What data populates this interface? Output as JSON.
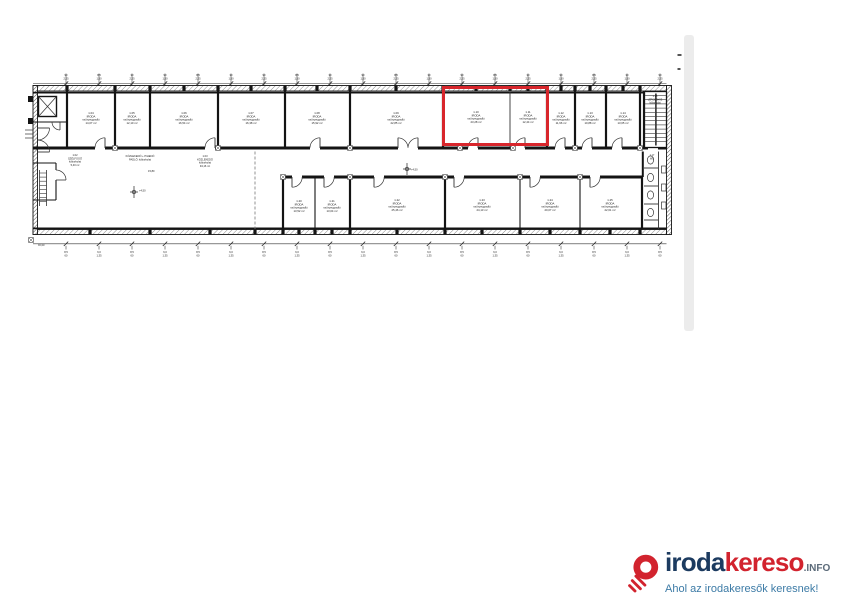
{
  "page": {
    "background": "#ffffff",
    "scrollbar_color": "#ececec"
  },
  "logo": {
    "brand_navy": "iroda",
    "brand_red": "kereso",
    "brand_suffix": ".INFO",
    "tagline": "Ahol az irodakeresők keresnek!",
    "colors": {
      "navy": "#1c3b60",
      "red": "#d2232e",
      "suffix": "#5c6b7a",
      "tagline": "#3d7ba6",
      "pin": "#d2232e"
    }
  },
  "plan": {
    "line_color": "#141414",
    "highlight": {
      "x": 443.5,
      "y": 87.5,
      "width": 104,
      "height": 57,
      "color": "#d8262c"
    },
    "upper_rooms": [
      {
        "x": 91,
        "y": 114,
        "lines": [
          "1.04",
          "IRODA",
          "szőnyegpadló",
          "14,07 m²"
        ]
      },
      {
        "x": 132,
        "y": 114,
        "lines": [
          "1.05",
          "IRODA",
          "szőnyegpadló",
          "12,10 m²"
        ]
      },
      {
        "x": 184,
        "y": 114,
        "lines": [
          "1.06",
          "IRODA",
          "szőnyegpadló",
          "16,54 m²"
        ]
      },
      {
        "x": 251,
        "y": 114,
        "lines": [
          "1.07",
          "IRODA",
          "szőnyegpadló",
          "16,38 m²"
        ]
      },
      {
        "x": 317,
        "y": 114,
        "lines": [
          "1.08",
          "IRODA",
          "szőnyegpadló",
          "15,92 m²"
        ]
      },
      {
        "x": 396,
        "y": 114,
        "lines": [
          "1.09",
          "IRODA",
          "szőnyegpadló",
          "22,85 m²"
        ]
      },
      {
        "x": 476,
        "y": 113,
        "lines": [
          "1.10",
          "IRODA",
          "szőnyegpadló",
          "23,28 m²"
        ]
      },
      {
        "x": 528,
        "y": 113,
        "lines": [
          "1.11",
          "IRODA",
          "szőnyegpadló",
          "12,44 m²"
        ]
      },
      {
        "x": 561,
        "y": 114,
        "lines": [
          "1.12",
          "IRODA",
          "szőnyegpadló",
          "11,96 m²"
        ]
      },
      {
        "x": 590,
        "y": 114,
        "lines": [
          "1.13",
          "IRODA",
          "szőnyegpadló",
          "10,88 m²"
        ]
      },
      {
        "x": 623,
        "y": 114,
        "lines": [
          "1.14",
          "IRODA",
          "szőnyegpadló",
          "13,65 m²"
        ]
      }
    ],
    "lower_rooms": [
      {
        "x": 299,
        "y": 202,
        "lines": [
          "1.20",
          "IRODA",
          "szőnyegpadló",
          "13,52 m²"
        ]
      },
      {
        "x": 332,
        "y": 202,
        "lines": [
          "1.21",
          "IRODA",
          "szőnyegpadló",
          "13,04 m²"
        ]
      },
      {
        "x": 397,
        "y": 201,
        "lines": [
          "1.22",
          "IRODA",
          "szőnyegpadló",
          "25,46 m²"
        ]
      },
      {
        "x": 482,
        "y": 201,
        "lines": [
          "1.23",
          "IRODA",
          "szőnyegpadló",
          "24,13 m²"
        ]
      },
      {
        "x": 550,
        "y": 201,
        "lines": [
          "1.24",
          "IRODA",
          "szőnyegpadló",
          "20,07 m²"
        ]
      },
      {
        "x": 610,
        "y": 201,
        "lines": [
          "1.25",
          "IRODA",
          "szőnyegpadló",
          "22,61 m²"
        ]
      }
    ],
    "other_labels": [
      {
        "x": 75,
        "y": 156,
        "size": 2.6,
        "lines": [
          "1.02",
          "SZÉLFOGÓ",
          "kőburkolat",
          "5,40 m²"
        ]
      },
      {
        "x": 140,
        "y": 157,
        "size": 2.6,
        "lines": [
          "KÖZLEKEDŐ + PIHENŐ",
          "PADLÓ: kőburkolat"
        ]
      },
      {
        "x": 205,
        "y": 157,
        "size": 2.6,
        "lines": [
          "1.03",
          "KÖZLEKEDŐ",
          "kőburkolat",
          "94,16 m²"
        ]
      },
      {
        "x": 655,
        "y": 97,
        "size": 2.4,
        "lines": [
          "1.15",
          "LÉPCSŐHÁZ",
          "kőburkolat"
        ]
      },
      {
        "x": 652,
        "y": 156,
        "size": 2.4,
        "lines": [
          "1.17",
          "WC"
        ]
      }
    ],
    "annotations": [
      {
        "x": 411,
        "y": 170.5,
        "text": "+4,50"
      },
      {
        "x": 139,
        "y": 191.5,
        "text": "+4,50"
      },
      {
        "x": 148,
        "y": 172,
        "text": "15,80"
      },
      {
        "x": 38,
        "y": 246,
        "text": "±0,00"
      }
    ],
    "top_ticks": {
      "items": [
        {
          "x": 66,
          "a": "90",
          "b": "2,25"
        },
        {
          "x": 99,
          "a": "8,5",
          "b": "1,50"
        },
        {
          "x": 132,
          "a": "30",
          "b": "2,25"
        },
        {
          "x": 165,
          "a": "90",
          "b": "1,50"
        },
        {
          "x": 198,
          "a": "8,5",
          "b": "2,25"
        },
        {
          "x": 231,
          "a": "30",
          "b": "1,50"
        },
        {
          "x": 264,
          "a": "90",
          "b": "2,25"
        },
        {
          "x": 297,
          "a": "8,5",
          "b": "1,50"
        },
        {
          "x": 330,
          "a": "30",
          "b": "2,25"
        },
        {
          "x": 363,
          "a": "90",
          "b": "1,50"
        },
        {
          "x": 396,
          "a": "8,5",
          "b": "2,25"
        },
        {
          "x": 429,
          "a": "30",
          "b": "1,50"
        },
        {
          "x": 462,
          "a": "90",
          "b": "2,25"
        },
        {
          "x": 495,
          "a": "8,5",
          "b": "1,50"
        },
        {
          "x": 528,
          "a": "30",
          "b": "2,25"
        },
        {
          "x": 561,
          "a": "90",
          "b": "1,50"
        },
        {
          "x": 594,
          "a": "8,5",
          "b": "2,25"
        },
        {
          "x": 627,
          "a": "30",
          "b": "1,50"
        },
        {
          "x": 660,
          "a": "90",
          "b": "2,25"
        }
      ]
    },
    "bottom_ticks": {
      "items": [
        {
          "x": 66,
          "a": "8,5",
          "b": "60"
        },
        {
          "x": 99,
          "a": "6,0",
          "b": "1,35"
        },
        {
          "x": 132,
          "a": "8,5",
          "b": "60"
        },
        {
          "x": 165,
          "a": "6,0",
          "b": "1,35"
        },
        {
          "x": 198,
          "a": "8,5",
          "b": "60"
        },
        {
          "x": 231,
          "a": "6,0",
          "b": "1,35"
        },
        {
          "x": 264,
          "a": "8,5",
          "b": "60"
        },
        {
          "x": 297,
          "a": "6,0",
          "b": "1,35"
        },
        {
          "x": 330,
          "a": "8,5",
          "b": "60"
        },
        {
          "x": 363,
          "a": "6,0",
          "b": "1,35"
        },
        {
          "x": 396,
          "a": "8,5",
          "b": "60"
        },
        {
          "x": 429,
          "a": "6,0",
          "b": "1,35"
        },
        {
          "x": 462,
          "a": "8,5",
          "b": "60"
        },
        {
          "x": 495,
          "a": "6,0",
          "b": "1,35"
        },
        {
          "x": 528,
          "a": "8,5",
          "b": "60"
        },
        {
          "x": 561,
          "a": "6,0",
          "b": "1,35"
        },
        {
          "x": 594,
          "a": "8,5",
          "b": "60"
        },
        {
          "x": 627,
          "a": "6,0",
          "b": "1,35"
        },
        {
          "x": 660,
          "a": "8,5",
          "b": "60"
        }
      ]
    }
  }
}
